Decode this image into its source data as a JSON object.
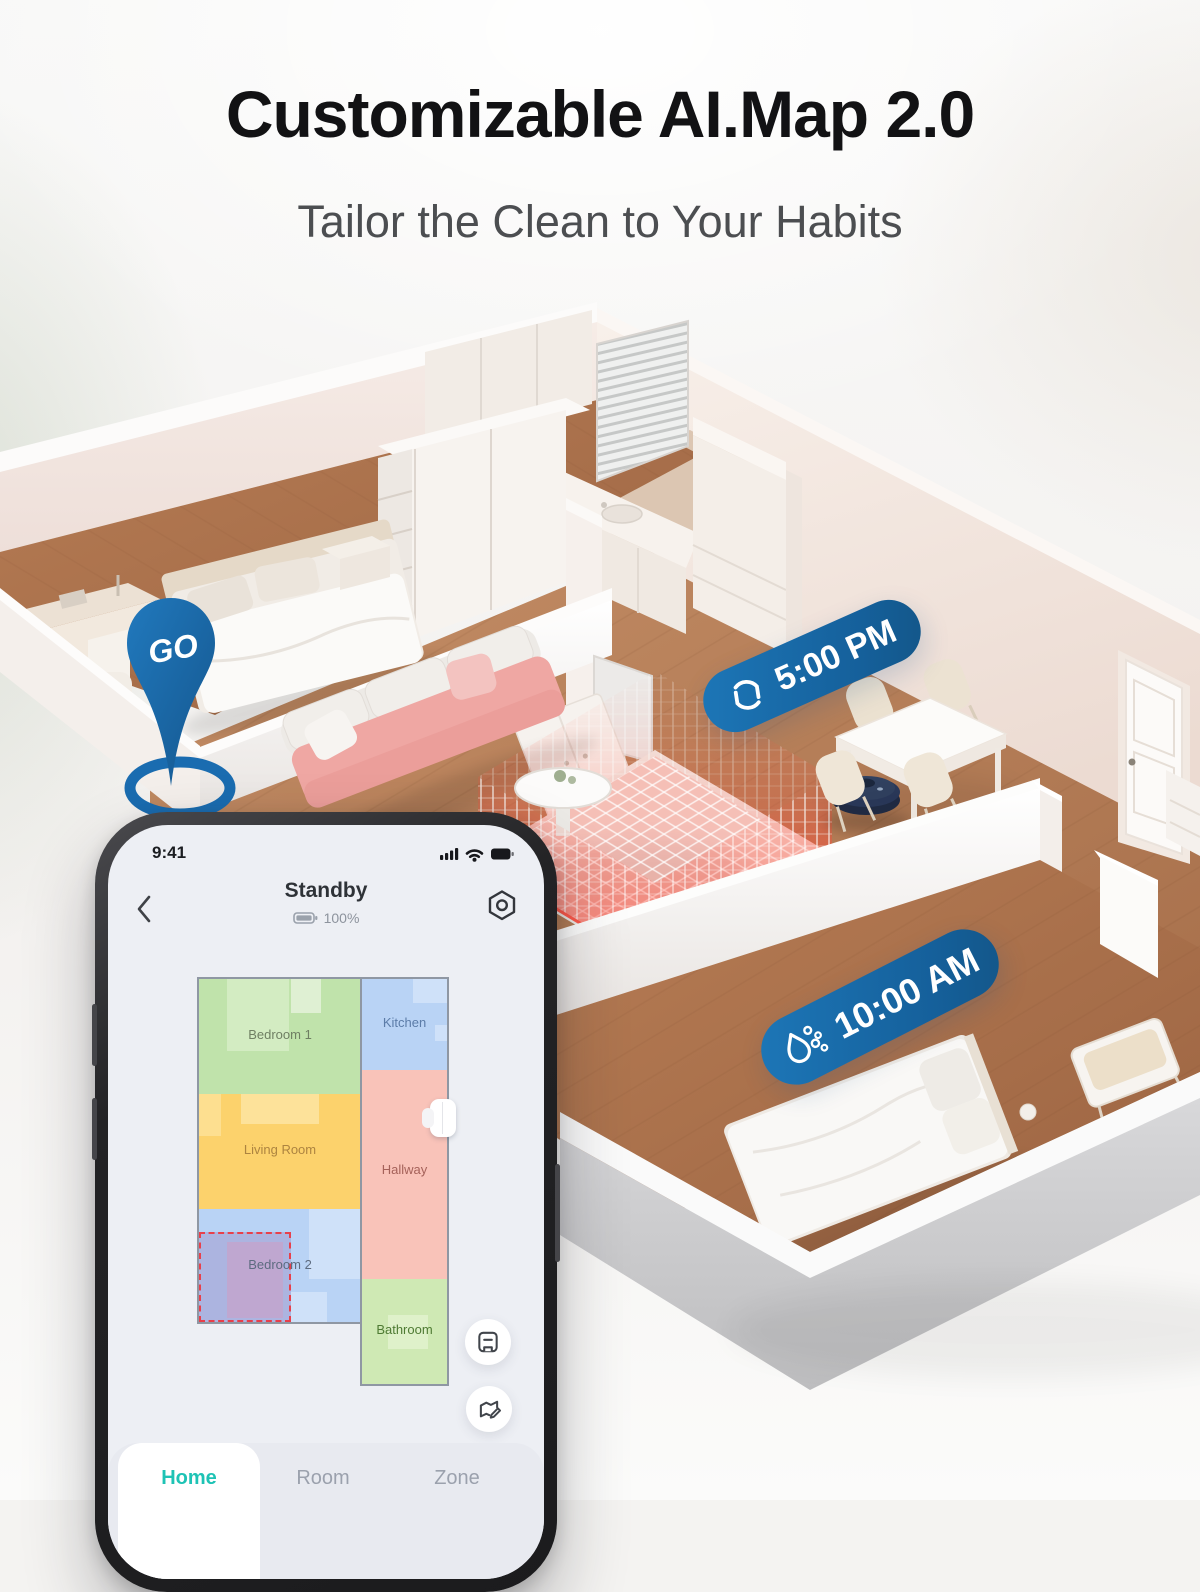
{
  "header": {
    "title": "Customizable AI.Map 2.0",
    "subtitle": "Tailor the Clean to Your Habits"
  },
  "scene": {
    "go_pin": {
      "label": "GO",
      "color": "#1a6cb0"
    },
    "badges": [
      {
        "icon": "spin-cycle-icon",
        "label": "5:00 PM"
      },
      {
        "icon": "water-drop-icon",
        "label": "10:00 AM"
      }
    ],
    "badge_blue": "#15609b"
  },
  "phone": {
    "status_bar": {
      "time": "9:41",
      "icons": [
        "signal-icon",
        "wifi-icon",
        "battery-icon"
      ]
    },
    "app_header": {
      "title": "Standby",
      "battery": "100%",
      "back_icon": "chevron-left-icon",
      "settings_icon": "gear-hexagon-icon"
    },
    "map": {
      "rooms": [
        {
          "name": "Bedroom 1",
          "fill": "#c0e3ab",
          "label_color": "#6f7f63"
        },
        {
          "name": "Kitchen",
          "fill": "#b9d3f5",
          "label_color": "#5c7ca8"
        },
        {
          "name": "Living Room",
          "fill": "#fcd26c",
          "label_color": "#ad8440"
        },
        {
          "name": "Hallway",
          "fill": "#f9c3b9",
          "label_color": "#a5625a"
        },
        {
          "name": "Bedroom 2",
          "fill": "#b9d3f5",
          "label_color": "#5d6b80"
        },
        {
          "name": "Bathroom",
          "fill": "#cfe9b4",
          "label_color": "#4e7a33"
        }
      ],
      "selected_room": "Bedroom 2",
      "dock_icon": "robot-dock-icon"
    },
    "action_buttons": [
      {
        "icon": "save-map-icon"
      },
      {
        "icon": "edit-map-icon"
      }
    ],
    "tabs": [
      {
        "label": "Home",
        "active": true
      },
      {
        "label": "Room",
        "active": false
      },
      {
        "label": "Zone",
        "active": false
      }
    ],
    "accent_color": "#1ec3b5"
  }
}
